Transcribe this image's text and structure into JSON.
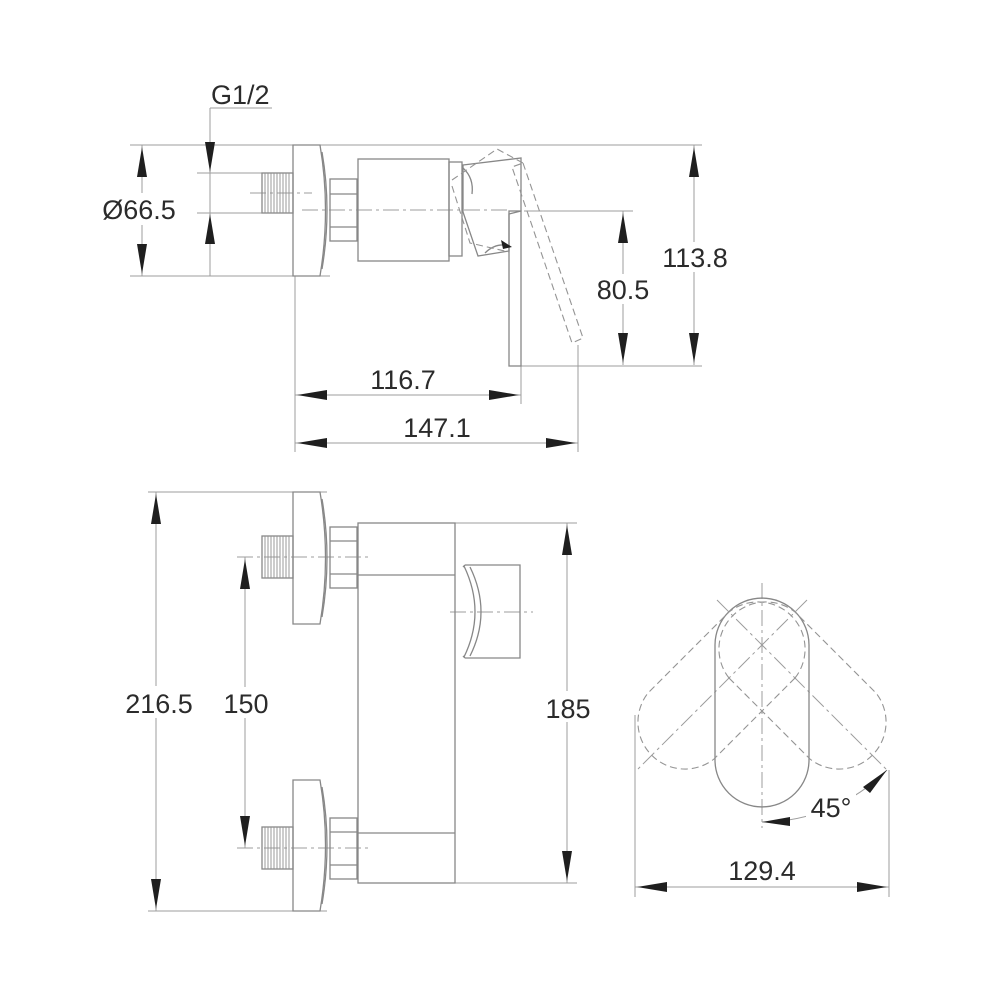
{
  "drawing": {
    "plan": {
      "thread_size": "G1/2",
      "escutcheon_diameter": "Ø66.5",
      "total_height": "113.8",
      "handle_drop": "80.5",
      "body_depth": "116.7",
      "total_depth": "147.1"
    },
    "elevation": {
      "total_height": "216.5",
      "inlet_spacing": "150",
      "body_height": "185"
    },
    "rotation": {
      "handle_angle": "45°",
      "swing_width": "129.4"
    }
  }
}
